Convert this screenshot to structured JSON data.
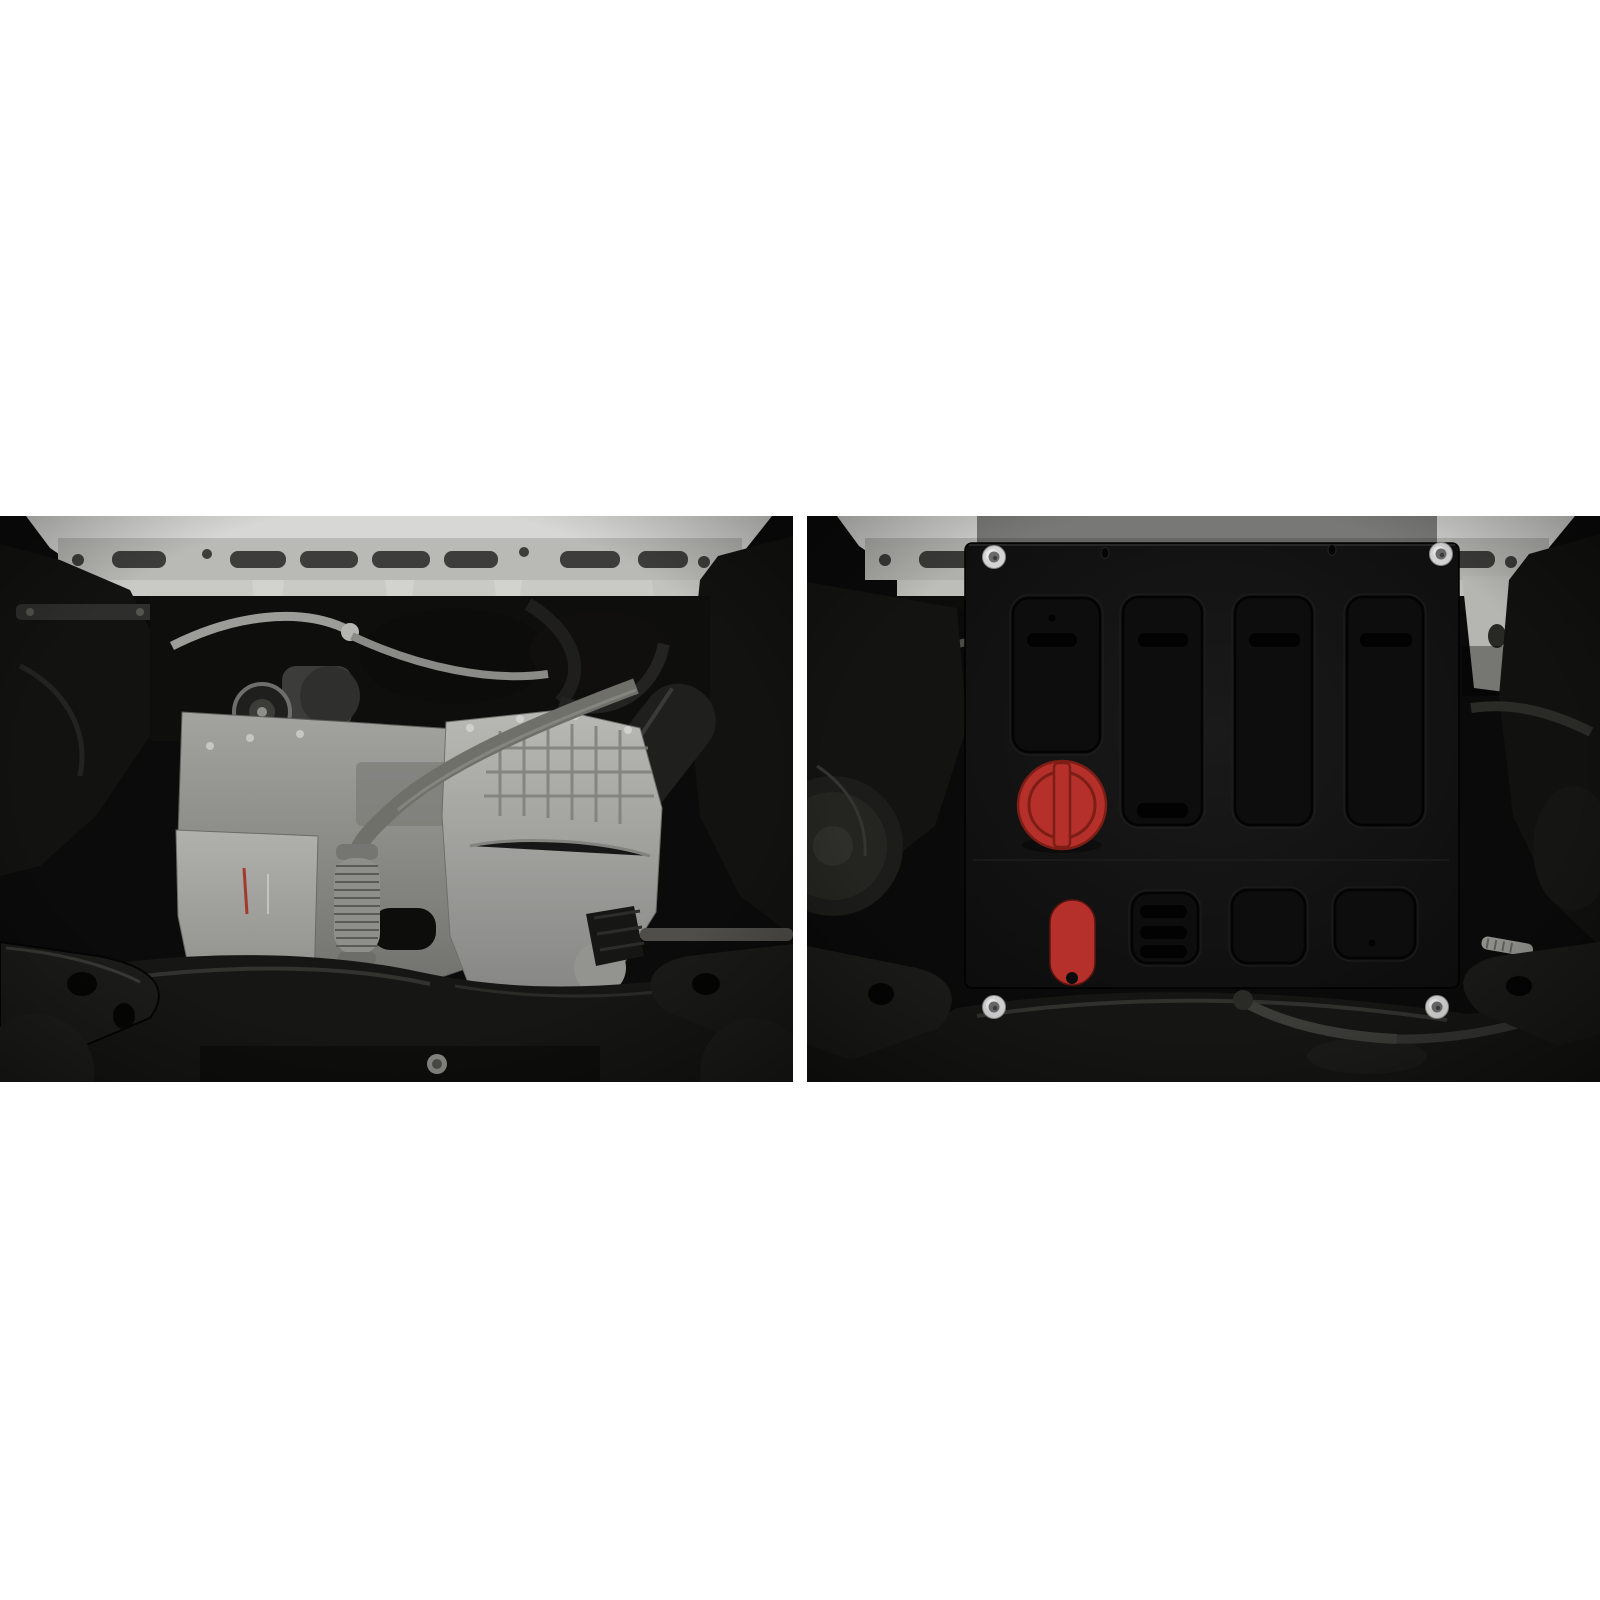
{
  "page": {
    "background": "#ffffff",
    "description": "Two-panel catalog photo of a car front underbody: left without protection, right with a black steel engine skid plate installed"
  },
  "panels": {
    "left": {
      "name": "underbody-before",
      "description": "Front underbody seen from below: white body crossmember on top, aluminium engine block and gearbox, exhaust downpipe with braided flex section, black subframe and control arms"
    },
    "right": {
      "name": "underbody-after",
      "description": "Same underbody view with a flat black steel skid plate bolted over the engine bay, with red oil-filler access cover and red drain-plug access cover"
    }
  },
  "palette": {
    "page_bg": "#ffffff",
    "photo_black": "#0a0a0a",
    "body_white": "#d7d7d5",
    "beam_gray": "#b9b9b5",
    "slot_gray": "#3d3d3b",
    "engine_silver": "#a3a39f",
    "trans_silver": "#b4b4b0",
    "pipe_gray": "#8e8e8a",
    "dark_metal": "#1b1b19",
    "plate_black": "#141414",
    "plate_recess": "#0d0d0d",
    "slot_black": "#020202",
    "red_cap": "#b5302a",
    "red_dark": "#7c1d16",
    "washer_silver": "#d4d4d4"
  },
  "skid_plate": {
    "frame": {
      "x": 158,
      "y": 27,
      "w": 494,
      "h": 445,
      "rx": 7
    },
    "bend_line_y": 344,
    "top_holes": [
      {
        "cx": 298,
        "cy": 37
      },
      {
        "cx": 525,
        "cy": 34
      }
    ],
    "recesses": [
      {
        "x": 206,
        "y": 82,
        "w": 87,
        "h": 154,
        "slots": [
          {
            "x": 220,
            "y": 117,
            "w": 50,
            "h": 14
          }
        ],
        "dot": {
          "cx": 245,
          "cy": 102
        }
      },
      {
        "x": 316,
        "y": 81,
        "w": 79,
        "h": 228,
        "slots": [
          {
            "x": 331,
            "y": 117,
            "w": 50,
            "h": 14
          },
          {
            "x": 330,
            "y": 287,
            "w": 51,
            "h": 15
          }
        ]
      },
      {
        "x": 428,
        "y": 81,
        "w": 77,
        "h": 228,
        "slots": [
          {
            "x": 442,
            "y": 117,
            "w": 51,
            "h": 14
          }
        ]
      },
      {
        "x": 540,
        "y": 81,
        "w": 76,
        "h": 228,
        "slots": [
          {
            "x": 553,
            "y": 117,
            "w": 52,
            "h": 14
          }
        ]
      },
      {
        "x": 325,
        "y": 377,
        "w": 66,
        "h": 70,
        "slots": [
          {
            "x": 333,
            "y": 389,
            "w": 47,
            "h": 13
          },
          {
            "x": 333,
            "y": 410,
            "w": 47,
            "h": 13
          },
          {
            "x": 333,
            "y": 429,
            "w": 47,
            "h": 13
          }
        ]
      },
      {
        "x": 425,
        "y": 374,
        "w": 73,
        "h": 73,
        "slots": []
      },
      {
        "x": 528,
        "y": 374,
        "w": 80,
        "h": 68,
        "slots": [],
        "dot": {
          "cx": 565,
          "cy": 427
        }
      }
    ],
    "oil_cap": {
      "cx": 255,
      "cy": 289,
      "r": 44,
      "bar_w": 16
    },
    "drain_plug": {
      "x": 243,
      "y": 384,
      "w": 45,
      "h": 85,
      "notch": {
        "cx": 265,
        "cy": 462,
        "r": 6
      }
    },
    "bolts": [
      {
        "cx": 187,
        "cy": 41
      },
      {
        "cx": 634,
        "cy": 38
      },
      {
        "cx": 187,
        "cy": 491
      },
      {
        "cx": 630,
        "cy": 491
      }
    ]
  }
}
